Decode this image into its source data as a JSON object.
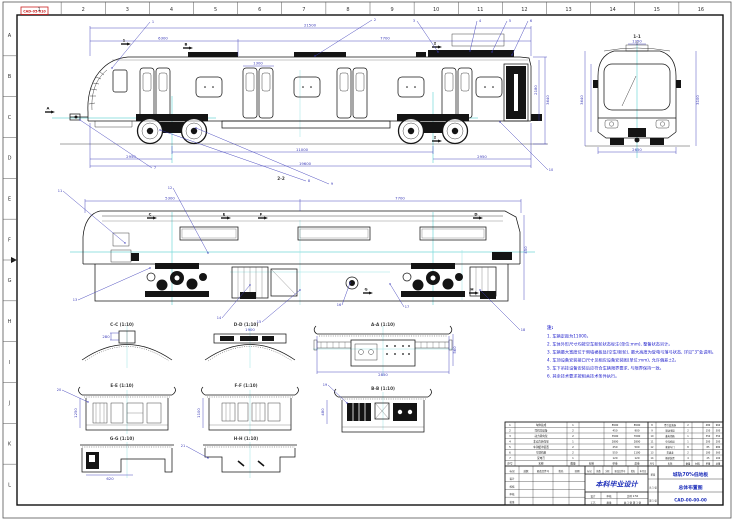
{
  "colors": {
    "outline": "#161616",
    "dimension": "#3a3ab8",
    "centerline": "#74d8d8",
    "note_blue": "#2222cc",
    "accent_blue": "#2233bb",
    "stamp_red": "#cc2222"
  },
  "border": {
    "top_numbers": [
      "1",
      "2",
      "3",
      "4",
      "5",
      "6",
      "7",
      "8",
      "9",
      "10",
      "11",
      "12",
      "13",
      "14",
      "15",
      "16"
    ],
    "left_letters": [
      "A",
      "B",
      "C",
      "D",
      "E",
      "F",
      "G",
      "H",
      "I",
      "J",
      "K",
      "L"
    ]
  },
  "stamp": {
    "text": "CAD-05-010"
  },
  "labels": [
    {
      "t": "1-1",
      "s": "",
      "x": 637,
      "y": 38
    },
    {
      "t": "2-2",
      "s": "",
      "x": 281,
      "y": 180
    },
    {
      "t": "A-A",
      "s": "(1:10)",
      "x": 383,
      "y": 326
    },
    {
      "t": "B-B",
      "s": "(1:10)",
      "x": 383,
      "y": 390
    },
    {
      "t": "C-C",
      "s": "(1:10)",
      "x": 122,
      "y": 326
    },
    {
      "t": "D-D",
      "s": "(1:10)",
      "x": 246,
      "y": 326
    },
    {
      "t": "E-E",
      "s": "(1:10)",
      "x": 122,
      "y": 387
    },
    {
      "t": "F-F",
      "s": "(1:10)",
      "x": 246,
      "y": 387
    },
    {
      "t": "G-G",
      "s": "(1:10)",
      "x": 122,
      "y": 440
    },
    {
      "t": "H-H",
      "s": "(1:10)",
      "x": 246,
      "y": 440
    }
  ],
  "flags": [
    {
      "t": "1",
      "x": 126,
      "y": 44
    },
    {
      "t": "B",
      "x": 188,
      "y": 48
    },
    {
      "t": "2",
      "x": 437,
      "y": 47
    },
    {
      "t": "2",
      "x": 437,
      "y": 141
    },
    {
      "t": "A",
      "x": 50,
      "y": 112
    },
    {
      "t": "C",
      "x": 152,
      "y": 218
    },
    {
      "t": "D",
      "x": 478,
      "y": 218
    },
    {
      "t": "E",
      "x": 226,
      "y": 218
    },
    {
      "t": "F",
      "x": 263,
      "y": 218
    },
    {
      "t": "G",
      "x": 368,
      "y": 293
    },
    {
      "t": "H",
      "x": 474,
      "y": 293
    }
  ],
  "dims": [
    {
      "x": 310,
      "y": 26.5,
      "t": "21500"
    },
    {
      "x": 163,
      "y": 39.5,
      "t": "6300"
    },
    {
      "x": 385,
      "y": 39.5,
      "t": "7700"
    },
    {
      "x": 258,
      "y": 64.5,
      "t": "1300"
    },
    {
      "x": 302,
      "y": 150.8,
      "t": "11000"
    },
    {
      "x": 131,
      "y": 157.8,
      "t": "2950"
    },
    {
      "x": 482,
      "y": 157.8,
      "t": "2950"
    },
    {
      "x": 305,
      "y": 164.8,
      "t": "19600"
    },
    {
      "x": 549,
      "y": 100,
      "t": "3640",
      "r": 1
    },
    {
      "x": 537,
      "y": 90,
      "t": "2180",
      "r": 1
    },
    {
      "x": 170,
      "y": 199.5,
      "t": "5300"
    },
    {
      "x": 400,
      "y": 199.5,
      "t": "7700"
    },
    {
      "x": 527,
      "y": 250,
      "t": "450",
      "r": 1
    },
    {
      "x": 583,
      "y": 100,
      "t": "3640",
      "r": 1
    },
    {
      "x": 699,
      "y": 100,
      "t": "3100",
      "r": 1
    },
    {
      "x": 637,
      "y": 151,
      "t": "2650"
    },
    {
      "x": 637,
      "y": 42.5,
      "t": "1250"
    },
    {
      "x": 106,
      "y": 338,
      "t": "280"
    },
    {
      "x": 250,
      "y": 331,
      "t": "1900"
    },
    {
      "x": 77,
      "y": 413,
      "t": "1250",
      "r": 1
    },
    {
      "x": 200,
      "y": 413,
      "t": "1100",
      "r": 1
    },
    {
      "x": 110,
      "y": 480,
      "t": "620"
    },
    {
      "x": 383,
      "y": 376,
      "t": "2850"
    },
    {
      "x": 456,
      "y": 350,
      "t": "560",
      "r": 1
    },
    {
      "x": 324,
      "y": 412,
      "t": "480",
      "r": 1
    }
  ],
  "leaders": [
    {
      "x1": 112,
      "y1": 68,
      "x2": 150,
      "y2": 22,
      "t": "1"
    },
    {
      "x1": 315,
      "y1": 56,
      "x2": 372,
      "y2": 20,
      "t": "2"
    },
    {
      "x1": 438,
      "y1": 52,
      "x2": 417,
      "y2": 21,
      "t": "3"
    },
    {
      "x1": 470,
      "y1": 51,
      "x2": 477,
      "y2": 21,
      "t": "4"
    },
    {
      "x1": 492,
      "y1": 52,
      "x2": 507,
      "y2": 21,
      "t": "5"
    },
    {
      "x1": 512,
      "y1": 55,
      "x2": 528,
      "y2": 21,
      "t": "6"
    },
    {
      "x1": 80,
      "y1": 120,
      "x2": 152,
      "y2": 168,
      "t": "7"
    },
    {
      "x1": 160,
      "y1": 130,
      "x2": 306,
      "y2": 181,
      "t": "8"
    },
    {
      "x1": 196,
      "y1": 128,
      "x2": 329,
      "y2": 184,
      "t": "9"
    },
    {
      "x1": 500,
      "y1": 122,
      "x2": 548,
      "y2": 170,
      "t": "10"
    },
    {
      "x1": 125,
      "y1": 243,
      "x2": 63,
      "y2": 191,
      "t": "11"
    },
    {
      "x1": 208,
      "y1": 253,
      "x2": 173,
      "y2": 188,
      "t": "12"
    },
    {
      "x1": 150,
      "y1": 268,
      "x2": 78,
      "y2": 300,
      "t": "13"
    },
    {
      "x1": 250,
      "y1": 285,
      "x2": 222,
      "y2": 318,
      "t": "14"
    },
    {
      "x1": 300,
      "y1": 290,
      "x2": 262,
      "y2": 322,
      "t": "15"
    },
    {
      "x1": 350,
      "y1": 283,
      "x2": 342,
      "y2": 305,
      "t": "16"
    },
    {
      "x1": 390,
      "y1": 284,
      "x2": 404,
      "y2": 307,
      "t": "17"
    },
    {
      "x1": 480,
      "y1": 290,
      "x2": 520,
      "y2": 330,
      "t": "18"
    },
    {
      "x1": 347,
      "y1": 403,
      "x2": 328,
      "y2": 385,
      "t": "19"
    },
    {
      "x1": 88,
      "y1": 402,
      "x2": 62,
      "y2": 390,
      "t": "20"
    },
    {
      "x1": 208,
      "y1": 458,
      "x2": 186,
      "y2": 446,
      "t": "21"
    }
  ],
  "notes": {
    "title": "注:",
    "items": [
      "1. 车辆定距为11000。",
      "2. 车体外形尺寸均按空车新轮状态标注(单位:mm), 整备状态另计。",
      "3. 车辆最大宽度位于侧墙裙板处(空车/新轮), 最大高度为受电弓落弓状态, 详见“3”处说明。",
      "4. 车顶设备安装接口尺寸见相应设备安装图(单位:mm), 允许偏差±2。",
      "5. 车下吊挂设备安装后应符合车辆限界要求, 与限界保持一致。",
      "6. 其余技术要求按相关技术条件执行。"
    ]
  },
  "bom": {
    "headers": [
      "序号",
      "名称",
      "数量",
      "材料",
      "单重",
      "总重"
    ],
    "left_rows": [
      [
        "1",
        "车体总成",
        "1",
        "",
        "8500",
        "8500"
      ],
      [
        "2",
        "司机室设备",
        "2",
        "",
        "450",
        "900"
      ],
      [
        "3",
        "动力转向架",
        "2",
        "",
        "3500",
        "7000"
      ],
      [
        "4",
        "非动力转向架",
        "1",
        "",
        "2800",
        "2800"
      ],
      [
        "5",
        "车钩缓冲装置",
        "2",
        "",
        "250",
        "500"
      ],
      [
        "6",
        "空调机组",
        "2",
        "",
        "550",
        "1100"
      ],
      [
        "7",
        "受电弓",
        "1",
        "",
        "120",
        "120"
      ]
    ],
    "right_rows": [
      [
        "8",
        "牵引变流器",
        "2",
        "",
        "480",
        "960"
      ],
      [
        "9",
        "制动电阻",
        "2",
        "",
        "150",
        "300"
      ],
      [
        "10",
        "蓄电池箱",
        "1",
        "",
        "350",
        "350"
      ],
      [
        "11",
        "空压机组",
        "1",
        "",
        "200",
        "200"
      ],
      [
        "12",
        "客室车门",
        "8",
        "",
        "85",
        "680"
      ],
      [
        "13",
        "贯通道",
        "2",
        "",
        "180",
        "360"
      ],
      [
        "14",
        "撒砂装置",
        "4",
        "",
        "25",
        "100"
      ]
    ]
  },
  "title_block": {
    "project": "本科毕业设计",
    "product": "城轨70%低地板",
    "sheet": "总体布置图",
    "drawing_no": "CAD-00-00-00",
    "change_row": [
      "标记",
      "处数",
      "分区",
      "更改文件号",
      "签名",
      "年月日"
    ],
    "revision_rows": [
      [
        "标记",
        "处数",
        "更改文件号",
        "签名",
        "日期"
      ],
      [
        "设计",
        "",
        "",
        "",
        ""
      ],
      [
        "校核",
        "",
        "",
        "",
        ""
      ],
      [
        "审核",
        "",
        "",
        "",
        ""
      ],
      [
        "批准",
        "",
        "",
        "",
        ""
      ]
    ],
    "bottom_rows": [
      [
        "设计",
        "审核",
        "比例 1:50"
      ],
      [
        "工艺",
        "批准",
        "共 1 张 第 1 张"
      ]
    ],
    "page_cells": [
      [
        "阶段"
      ],
      [
        "共 1 张"
      ],
      [
        "第 1 张"
      ]
    ]
  }
}
